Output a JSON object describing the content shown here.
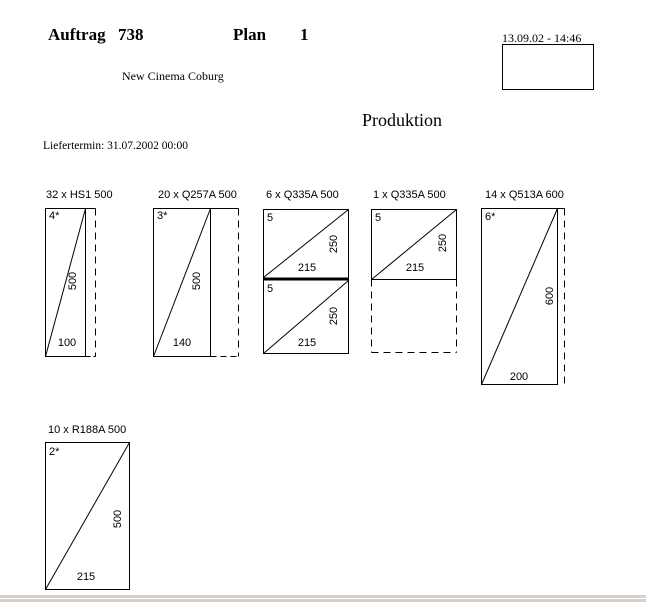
{
  "window": {
    "background": "#ffffff",
    "line_color": "#000000",
    "scrollbar_color": "#d6d2ca"
  },
  "header": {
    "order_label": "Auftrag",
    "order_number": "738",
    "plan_label": "Plan",
    "plan_number": "1",
    "datetime": "13.09.02 - 14:46",
    "customer": "New Cinema Coburg",
    "section_title": "Produktion",
    "delivery_label": "Liefertermin: 31.07.2002 00:00"
  },
  "panels": [
    {
      "title": "32 x HS1 500",
      "cells": [
        {
          "mark": "4*",
          "height_dim": "500",
          "width_dim": "100"
        }
      ]
    },
    {
      "title": "20 x Q257A 500",
      "cells": [
        {
          "mark": "3*",
          "height_dim": "500",
          "width_dim": "140"
        }
      ]
    },
    {
      "title": "6 x Q335A 500",
      "cells": [
        {
          "mark": "5",
          "height_dim": "250",
          "width_dim": "215"
        },
        {
          "mark": "5",
          "height_dim": "250",
          "width_dim": "215"
        }
      ]
    },
    {
      "title": "1 x Q335A 500",
      "cells": [
        {
          "mark": "5",
          "height_dim": "250",
          "width_dim": "215"
        }
      ]
    },
    {
      "title": "14 x Q513A 600",
      "cells": [
        {
          "mark": "6*",
          "height_dim": "600",
          "width_dim": "200"
        }
      ]
    },
    {
      "title": "10 x R188A 500",
      "cells": [
        {
          "mark": "2*",
          "height_dim": "500",
          "width_dim": "215"
        }
      ]
    }
  ]
}
